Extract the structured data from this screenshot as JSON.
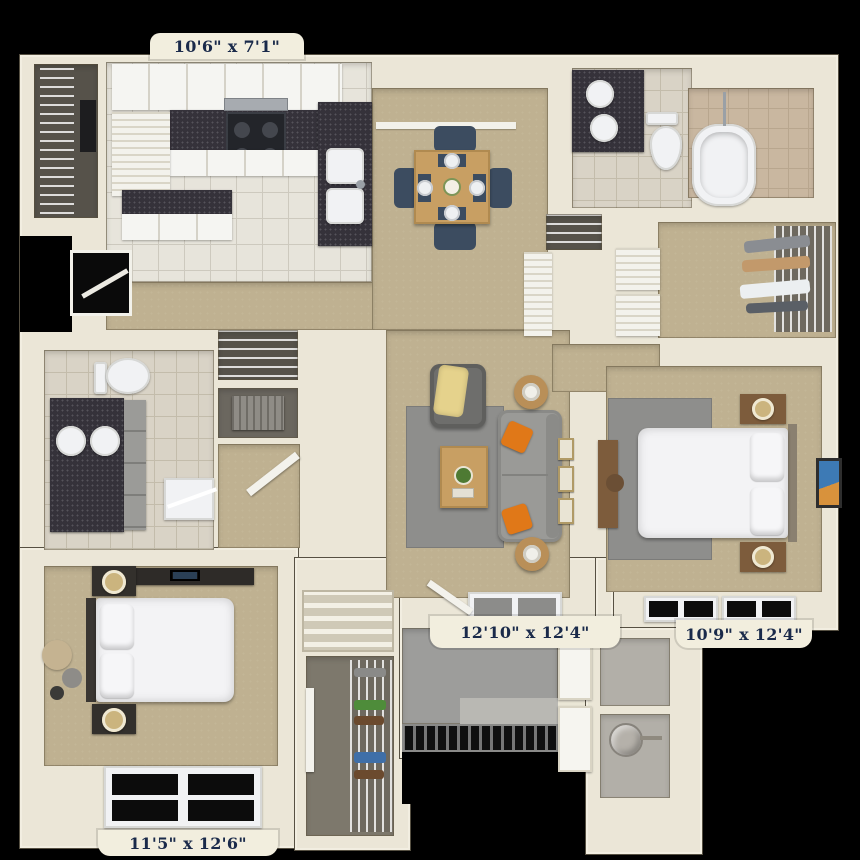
{
  "title": "3D apartment floor plan (top-down render)",
  "background": "#000000",
  "dimension_labels": {
    "kitchen": "10'6\" x 7'1\"",
    "living_room": "12'10\" x 12'4\"",
    "bedroom_right": "10'9\" x 12'4\"",
    "bedroom_left": "11'5\" x 12'6\""
  },
  "rooms": [
    {
      "name": "Kitchen",
      "dimensions": "10'6\" x 7'1\"",
      "features": [
        "upper-cabinets",
        "granite-counter",
        "stove",
        "microwave",
        "double-sink-peninsula",
        "pantry",
        "breakfast-bar"
      ]
    },
    {
      "name": "Dining Area",
      "features": [
        "square-wood-table",
        "4-navy-chairs",
        "4-place-settings",
        "centerpiece"
      ]
    },
    {
      "name": "Living Room",
      "dimensions": "12'10\" x 12'4\"",
      "features": [
        "gray-sofa",
        "2-orange-pillows",
        "armchair-with-yellow-throw",
        "wood-coffee-table",
        "2-round-side-tables-with-lamps",
        "gray-area-rug",
        "wall-art"
      ]
    },
    {
      "name": "Bedroom (right)",
      "dimensions": "10'9\" x 12'4\"",
      "features": [
        "bed",
        "2-nightstands-with-lamps",
        "desk",
        "gray-rug",
        "wall-art",
        "south-windows"
      ]
    },
    {
      "name": "Bedroom (left)",
      "dimensions": "11'5\" x 12'6\"",
      "features": [
        "bed",
        "2-nightstands-with-lamps",
        "media-dresser-with-tv",
        "wall-circle-decor",
        "south-window"
      ]
    },
    {
      "name": "Bathroom (top)",
      "features": [
        "double-sink-granite-vanity",
        "toilet",
        "soaking-tub",
        "tiled-shower-alcove"
      ]
    },
    {
      "name": "Bathroom (left)",
      "features": [
        "double-sink-granite-vanity",
        "linen-tower",
        "toilet",
        "shower"
      ]
    },
    {
      "name": "Walk-in Closet",
      "features": [
        "wire-shelving",
        "hanging-clothes",
        "louvered-double-doors"
      ]
    },
    {
      "name": "Laundry Closet",
      "features": [
        "wire-shelving",
        "appliance"
      ]
    },
    {
      "name": "Entry / Stairs",
      "features": [
        "staircase",
        "shoe-closet-wire-shelves",
        "metal-grate-landing"
      ]
    },
    {
      "name": "Utility / Storage",
      "features": [
        "water-heater",
        "storage-compartment",
        "paneled-doors"
      ]
    }
  ],
  "palette": {
    "background": "#000000",
    "walls": "#ebe6d7",
    "carpet_tan": "#bfb191",
    "kitchen_tile": "#e7e4db",
    "bath_tile": "#d9d3c6",
    "granite": "#35323a",
    "sofa_gray": "#9a9a97",
    "rug_gray": "#8e8e8c",
    "wood": "#c89f63",
    "chair_navy": "#3c4c60",
    "pillow_orange": "#e07818",
    "throw_yellow": "#e5d28c",
    "nightstand_brown": "#7d5c3c",
    "label_bg": "#f2eede",
    "label_text": "#1a2a4a"
  }
}
